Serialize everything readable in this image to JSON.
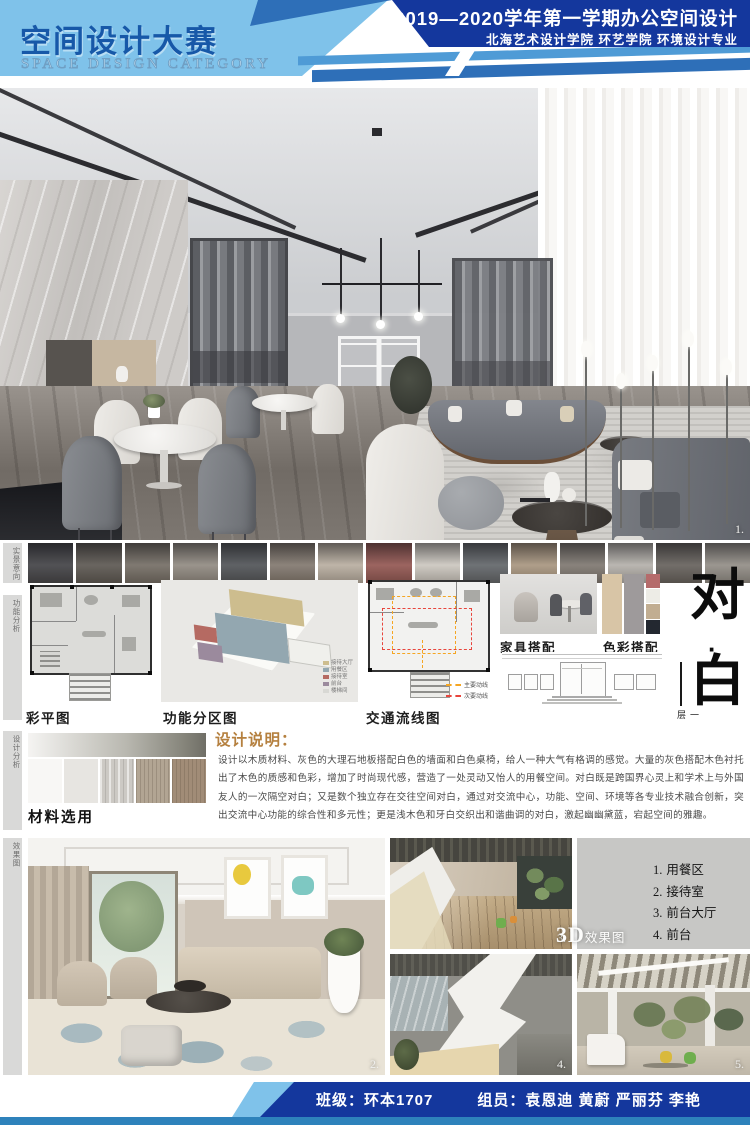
{
  "header": {
    "title_cn": "空间设计大赛",
    "title_en": "SPACE DESIGN CATEGORY",
    "course_title": "2019—2020学年第一学期办公空间设计",
    "school_line": "北海艺术设计学院  环艺学院  环境设计专业",
    "colors": {
      "navy": "#14379d",
      "medium_blue": "#2e6fb8",
      "light_blue": "#7fc2ea",
      "title_blue": "#1758a8"
    }
  },
  "side_tabs": [
    {
      "label": "实景意向"
    },
    {
      "label": "功能分析"
    },
    {
      "label": "设计分析"
    },
    {
      "label": "效果图"
    }
  ],
  "reference_strip": {
    "thumbs": [
      "#3a3a3e",
      "#55504a",
      "#6e675e",
      "#8c857c",
      "#494c50",
      "#7c7268",
      "#b5aa9c",
      "#8e4f4a",
      "#c9c4bc",
      "#5b5f63",
      "#a4917a",
      "#78716a",
      "#b0aca6",
      "#5f5a55",
      "#8d8881"
    ]
  },
  "plans": {
    "color_plan_label": "彩平图",
    "zoning_label": "功能分区图",
    "zoning_legend": [
      {
        "color": "#cdbd8e",
        "label": "接待大厅"
      },
      {
        "color": "#93a7b0",
        "label": "用餐区"
      },
      {
        "color": "#b56a62",
        "label": "接待室"
      },
      {
        "color": "#9b8a9d",
        "label": "前台"
      },
      {
        "color": "#d8d8d4",
        "label": "楼梯间"
      }
    ],
    "circulation_label": "交通流线图",
    "circulation_legend": [
      {
        "color": "#f5a623",
        "label": "主要动线"
      },
      {
        "color": "#e8453c",
        "label": "次要动线"
      }
    ]
  },
  "matching": {
    "furniture_label": "家具搭配",
    "color_label": "色彩搭配",
    "palette_large": [
      "#d8c5a6",
      "#9e9a9b"
    ],
    "palette_small": [
      "#b56b6b",
      "#edece6",
      "#c1ad91",
      "#232830"
    ]
  },
  "theme": {
    "char1": "对",
    "dot": "·",
    "char2": "白",
    "floor": "一层"
  },
  "description": {
    "title": "设计说明：",
    "body": "设计以木质材料、灰色的大理石地板搭配白色的墙面和白色桌椅，给人一种大气有格调的感觉。大量的灰色搭配木色衬托出了木色的质感和色彩，增加了时尚现代感，营造了一处灵动又怡人的用餐空间。对白既是跨国界心灵上和学术上与外国友人的一次隔空对白；又是数个独立存在交往空间对白，通过对交流中心，功能、空间、环境等各专业技术融合创新，突出交流中心功能的综合性和多元性；更是浅木色和牙白交织出和谐曲调的对白，激起幽幽黛蓝，宕起空间的雅趣。"
  },
  "materials": {
    "label": "材料选用",
    "swatches": [
      "#f8f7f5",
      "#e7e5e1",
      "#ccc9c4",
      "#b2a593",
      "#a18c77"
    ]
  },
  "renders": {
    "overlay_3d": "3D",
    "overlay_suffix": "效果图",
    "areas": [
      {
        "num": "1.",
        "name": "用餐区"
      },
      {
        "num": "2.",
        "name": "接待室"
      },
      {
        "num": "3.",
        "name": "前台大厅"
      },
      {
        "num": "4.",
        "name": "前台"
      },
      {
        "num": "5.",
        "name": "大厅接待区"
      }
    ],
    "image_numbers": {
      "hero": "1.",
      "reception": "2.",
      "lobby": "3.",
      "front_desk": "4.",
      "hall": "5."
    }
  },
  "footer": {
    "class_label": "班级：环本1707",
    "members_label": "组员：袁恩迪  黄蔚  严丽芬  李艳"
  }
}
